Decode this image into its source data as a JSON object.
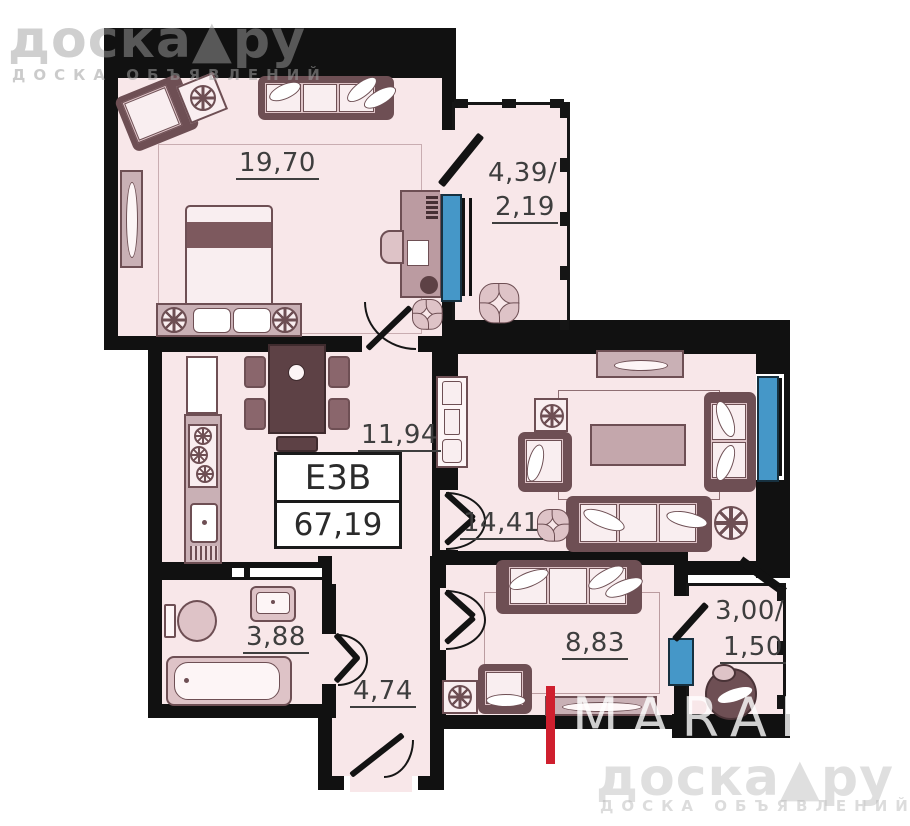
{
  "watermark_top": {
    "brand": "доска▲ру",
    "tagline": "ДОСКА ОБЪЯВЛЕНИЙ"
  },
  "watermark_bottom": {
    "brand": "доска▲ру",
    "tagline": "ДОСКА ОБЪЯВЛЕНИЙ"
  },
  "agency": {
    "name": "MARAL",
    "tagline": "Real Estate"
  },
  "unit": {
    "code": "Е3В",
    "total_area": "67,19"
  },
  "areas": {
    "bedroom_main": "19,70",
    "balcony_top_total": "4,39/",
    "balcony_top_reduced": "2,19",
    "kitchen": "11,94",
    "living": "14,41",
    "bathroom": "3,88",
    "hallway": "4,74",
    "bedroom_second": "8,83",
    "balcony_bottom_total": "3,00/",
    "balcony_bottom_reduced": "1,50"
  },
  "icons": {
    "plant": "css-leaf-cluster",
    "ceiling-fan": "css-spoked-circle",
    "brand-separator": "▲"
  },
  "colors": {
    "wall": "#111111",
    "room_fill": "#f8e7e9",
    "furniture_dark": "#6e4f54",
    "window_blue": "#4597c8",
    "accent_red": "#cf1f2e",
    "label_text": "#3e3e3e"
  }
}
